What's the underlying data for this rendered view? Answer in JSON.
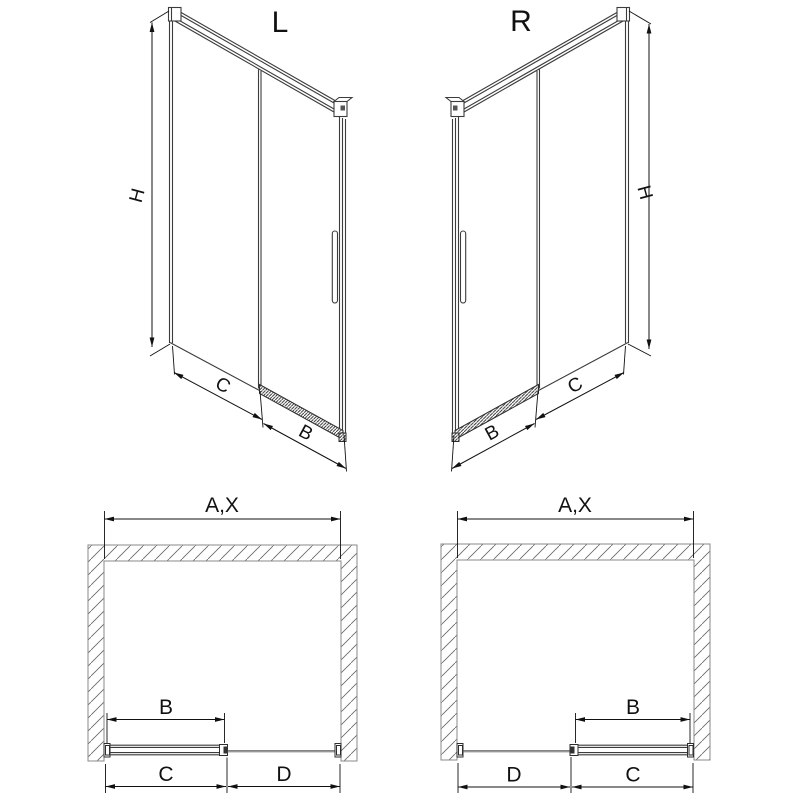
{
  "drawing": {
    "type": "technical-drawing",
    "subject": "sliding shower door, left and right versions, isometric and plan installation views"
  },
  "views": {
    "iso_l": {
      "title": "L",
      "dim_h": "H",
      "dim_c": "C",
      "dim_b": "B"
    },
    "iso_r": {
      "title": "R",
      "dim_h": "H",
      "dim_c": "C",
      "dim_b": "B"
    },
    "plan_l": {
      "dim_ax": "A,X",
      "dim_b": "B",
      "dim_c": "C",
      "dim_d": "D"
    },
    "plan_r": {
      "dim_ax": "A,X",
      "dim_b": "B",
      "dim_c": "C",
      "dim_d": "D"
    }
  },
  "colors": {
    "background": "#ffffff",
    "structure_line": "#3c3c3c",
    "dimension_line": "#111111",
    "wall_outline": "#8a8a8a"
  }
}
